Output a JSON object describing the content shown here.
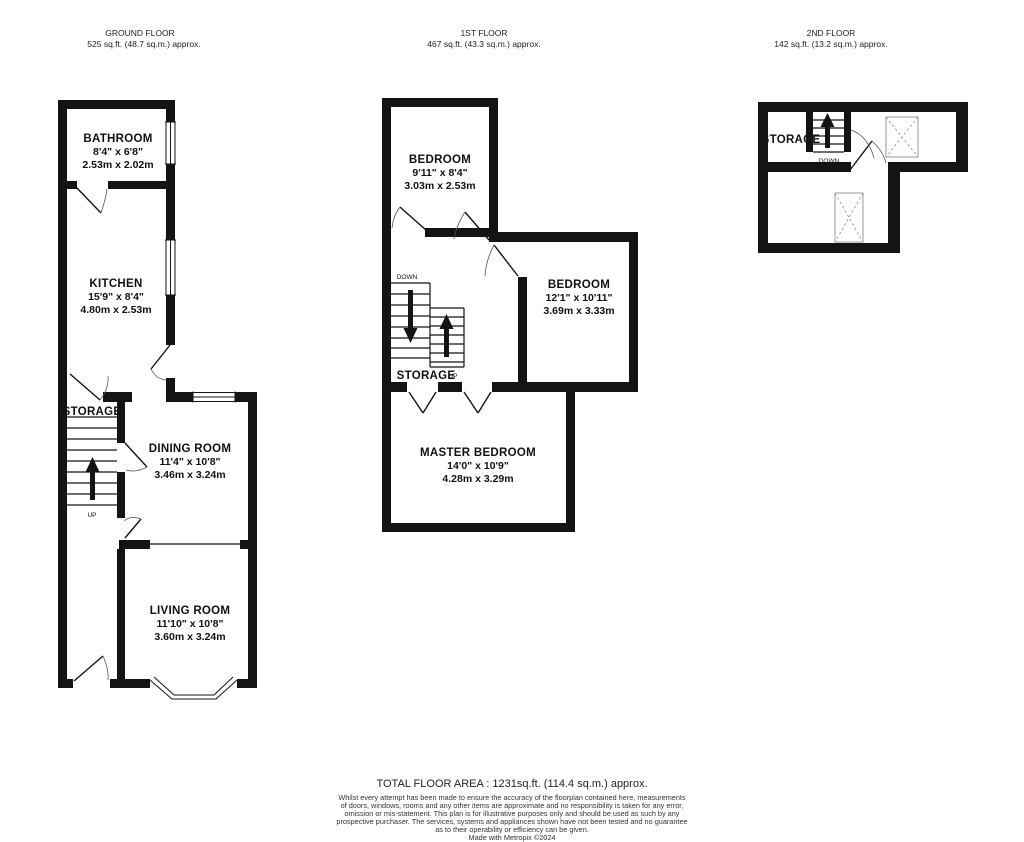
{
  "floors": {
    "ground": {
      "title": "GROUND FLOOR",
      "area": "525 sq.ft. (48.7 sq.m.) approx.",
      "bathroom": {
        "name": "BATHROOM",
        "imperial": "8'4\" x 6'8\"",
        "metric": "2.53m x 2.02m"
      },
      "kitchen": {
        "name": "KITCHEN",
        "imperial": "15'9\" x 8'4\"",
        "metric": "4.80m x 2.53m"
      },
      "storage": {
        "name": "STORAGE",
        "up": "UP"
      },
      "dining": {
        "name": "DINING ROOM",
        "imperial": "11'4\" x 10'8\"",
        "metric": "3.46m x 3.24m"
      },
      "living": {
        "name": "LIVING ROOM",
        "imperial": "11'10\" x 10'8\"",
        "metric": "3.60m x 3.24m"
      }
    },
    "first": {
      "title": "1ST FLOOR",
      "area": "467 sq.ft. (43.3 sq.m.) approx.",
      "bedroom1": {
        "name": "BEDROOM",
        "imperial": "9'11\" x 8'4\"",
        "metric": "3.03m x 2.53m"
      },
      "bedroom2": {
        "name": "BEDROOM",
        "imperial": "12'1\" x 10'11\"",
        "metric": "3.69m x 3.33m"
      },
      "master": {
        "name": "MASTER BEDROOM",
        "imperial": "14'0\" x 10'9\"",
        "metric": "4.28m x 3.29m"
      },
      "storage": {
        "name": "STORAGE",
        "down": "DOWN",
        "up": "UP"
      }
    },
    "second": {
      "title": "2ND FLOOR",
      "area": "142 sq.ft. (13.2 sq.m.) approx.",
      "storage": {
        "name": "STORAGE",
        "down": "DOWN"
      }
    }
  },
  "footer": {
    "total": "TOTAL FLOOR AREA : 1231sq.ft. (114.4 sq.m.) approx.",
    "disclaimer": [
      "Whilst every attempt has been made to ensure the accuracy of the floorplan contained here, measurements",
      "of doors, windows, rooms and any other items are approximate and no responsibility is taken for any error,",
      "omission or mis-statement. This plan is for illustrative purposes only and should be used as such by any",
      "prospective purchaser. The services, systems and appliances shown have not been tested and no guarantee",
      "as to their operability or efficiency can be given."
    ],
    "credit": "Made with Metropix ©2024"
  }
}
